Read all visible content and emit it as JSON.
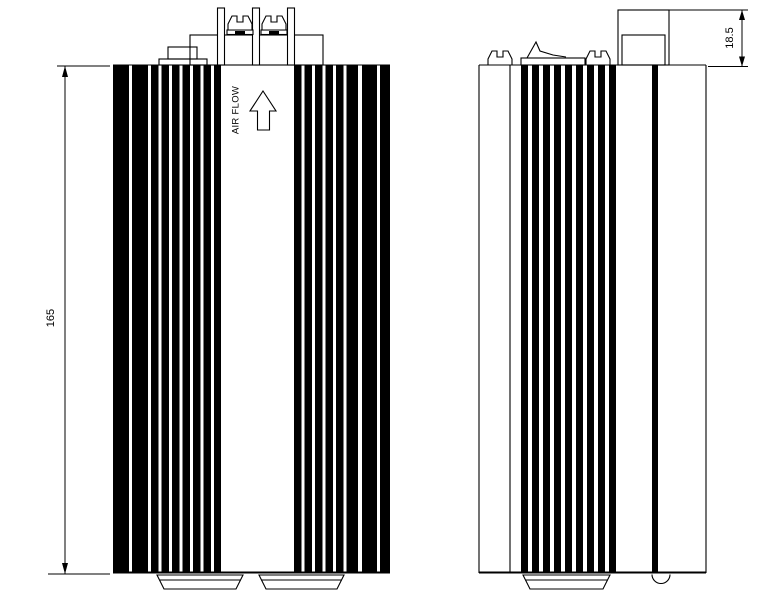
{
  "document": {
    "background": "#ffffff",
    "ink": "#000000"
  },
  "labels": {
    "air_flow": "AIR FLOW"
  },
  "dimensions": {
    "overall_height": {
      "value": "165"
    },
    "terminal_block_height": {
      "value": "18.5"
    }
  }
}
